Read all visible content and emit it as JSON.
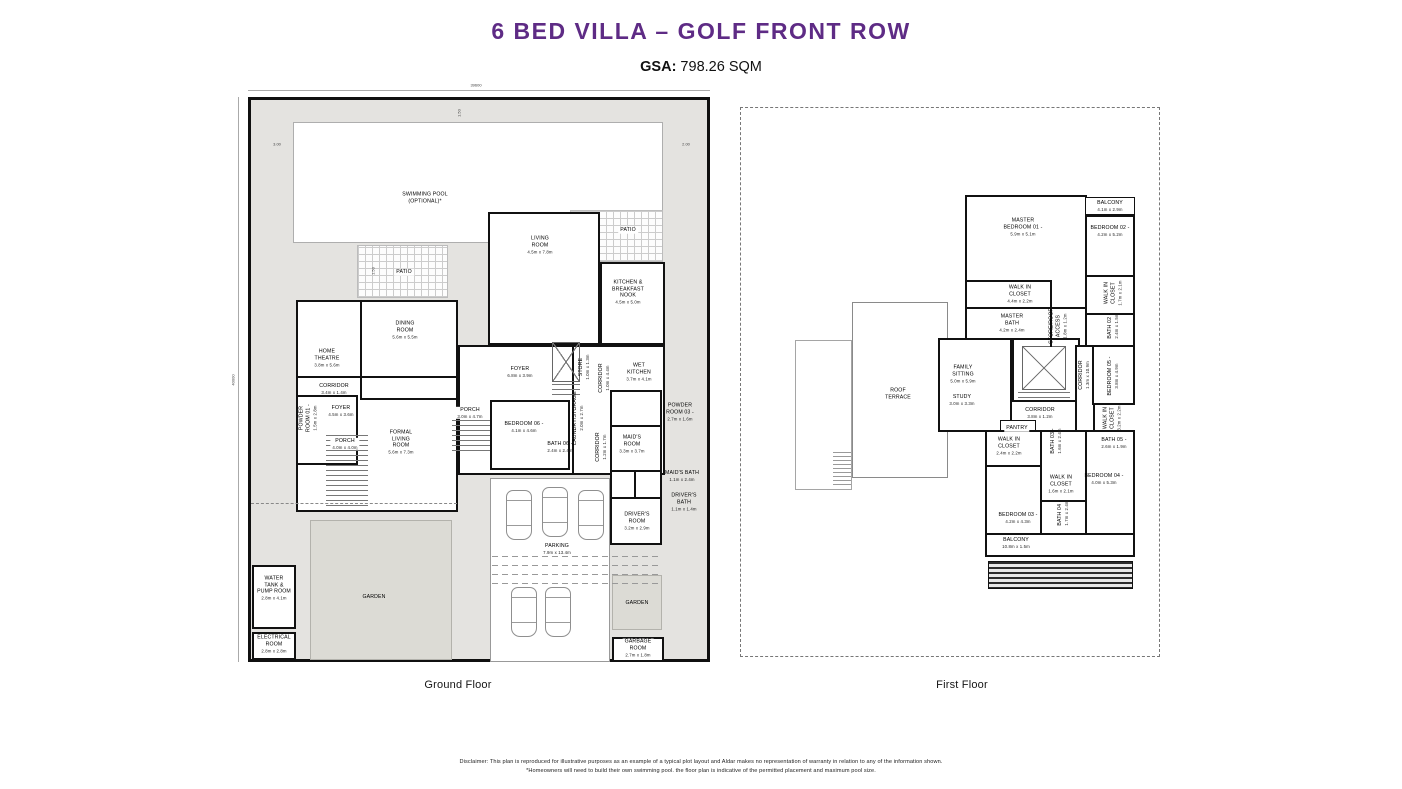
{
  "header": {
    "title_main": "6 BED VILLA",
    "title_sep": " – ",
    "title_sub": "GOLF FRONT ROW",
    "gsa_label": "GSA:",
    "gsa_value": " 798.26 SQM",
    "title_color": "#5E2B85"
  },
  "colors": {
    "accent_purple": "#5E2B85",
    "plot_fill": "#E4E3E0",
    "garden_fill": "#DCDBD5",
    "wall": "#101010"
  },
  "ground": {
    "caption": "Ground Floor",
    "dim_labels": [
      {
        "t": "39600",
        "x": 476,
        "y": 85,
        "r": 0
      },
      {
        "t": "40000",
        "x": 233,
        "y": 380,
        "r": 1
      },
      {
        "t": "3.00",
        "x": 277,
        "y": 144,
        "r": 0
      },
      {
        "t": "2.00",
        "x": 686,
        "y": 144,
        "r": 0
      },
      {
        "t": "1.50",
        "x": 459,
        "y": 113,
        "r": 1
      },
      {
        "t": "1.50",
        "x": 373,
        "y": 271,
        "r": 1
      }
    ],
    "labels": [
      {
        "n": "SWIMMING POOL\n(OPTIONAL)*",
        "d": "",
        "x": 425,
        "y": 198,
        "r": 0
      },
      {
        "n": "PATIO",
        "d": "",
        "x": 404,
        "y": 272,
        "r": 0,
        "w": 1
      },
      {
        "n": "PATIO",
        "d": "",
        "x": 628,
        "y": 230,
        "r": 0,
        "w": 1
      },
      {
        "n": "LIVING\nROOM",
        "d": "4.5m x 7.8m",
        "x": 540,
        "y": 245,
        "r": 0
      },
      {
        "n": "KITCHEN &\nBREAKFAST\nNOOK",
        "d": "4.5m x 5.0m",
        "x": 628,
        "y": 292,
        "r": 0
      },
      {
        "n": "DINING\nROOM",
        "d": "5.6m x 5.5m",
        "x": 405,
        "y": 330,
        "r": 0
      },
      {
        "n": "HOME\nTHEATRE",
        "d": "3.8m x 5.6m",
        "x": 327,
        "y": 358,
        "r": 0
      },
      {
        "n": "CORRIDOR",
        "d": "3.4m x 1.4m",
        "x": 334,
        "y": 389,
        "r": 0
      },
      {
        "n": "FOYER",
        "d": "6.8m x 3.9m",
        "x": 520,
        "y": 372,
        "r": 0
      },
      {
        "n": "STORE",
        "d": "1.0m x 1.3m",
        "x": 584,
        "y": 367,
        "r": 1
      },
      {
        "n": "CORRIDOR",
        "d": "1.0m x 4.4m",
        "x": 604,
        "y": 378,
        "r": 1
      },
      {
        "n": "WET\nKITCHEN",
        "d": "3.7m x 4.1m",
        "x": 639,
        "y": 372,
        "r": 0
      },
      {
        "n": "POWDER\nROOM 01 -",
        "d": "1.5m x 2.8m",
        "x": 308,
        "y": 418,
        "r": 1
      },
      {
        "n": "FOYER",
        "d": "4.5m x 3.6m",
        "x": 341,
        "y": 411,
        "r": 0
      },
      {
        "n": "PORCH",
        "d": "4.0m x 4.0m",
        "x": 345,
        "y": 444,
        "r": 0,
        "w": 1
      },
      {
        "n": "FORMAL\nLIVING\nROOM",
        "d": "5.6m x 7.3m",
        "x": 401,
        "y": 442,
        "r": 0
      },
      {
        "n": "PORCH",
        "d": "3.0m x 4.7m",
        "x": 470,
        "y": 413,
        "r": 0,
        "w": 1
      },
      {
        "n": "BEDROOM 06 -",
        "d": "4.1m x 4.6m",
        "x": 524,
        "y": 427,
        "r": 0
      },
      {
        "n": "BATH 06 -",
        "d": "2.4m x 2.4m",
        "x": 560,
        "y": 447,
        "r": 0
      },
      {
        "n": "LAUNDRY/STORAGE",
        "d": "2.0m x 2.7m",
        "x": 578,
        "y": 418,
        "r": 1
      },
      {
        "n": "CORRIDOR",
        "d": "1.2m x 1.7m",
        "x": 601,
        "y": 447,
        "r": 1
      },
      {
        "n": "MAID'S\nROOM",
        "d": "3.3m x 3.7m",
        "x": 632,
        "y": 444,
        "r": 0
      },
      {
        "n": "POWDER\nROOM 03 -",
        "d": "2.7m x 1.6m",
        "x": 680,
        "y": 412,
        "r": 0
      },
      {
        "n": "MAID'S BATH",
        "d": "1.1m x 2.4m",
        "x": 682,
        "y": 476,
        "r": 0
      },
      {
        "n": "DRIVER'S\nBATH",
        "d": "1.1m x 1.4m",
        "x": 684,
        "y": 502,
        "r": 0
      },
      {
        "n": "DRIVER'S\nROOM",
        "d": "3.2m x 2.9m",
        "x": 637,
        "y": 521,
        "r": 0
      },
      {
        "n": "PARKING",
        "d": "7.9m x 13.4m",
        "x": 557,
        "y": 549,
        "r": 0,
        "w": 1
      },
      {
        "n": "GARDEN",
        "d": "",
        "x": 374,
        "y": 597,
        "r": 0
      },
      {
        "n": "GARDEN",
        "d": "",
        "x": 637,
        "y": 603,
        "r": 0
      },
      {
        "n": "GARBAGE\nROOM",
        "d": "2.7m x 1.8m",
        "x": 638,
        "y": 648,
        "r": 0,
        "w": 1
      },
      {
        "n": "WATER\nTANK &\nPUMP ROOM",
        "d": "2.8m x 4.1m",
        "x": 274,
        "y": 588,
        "r": 0
      },
      {
        "n": "ELECTRICAL\nROOM",
        "d": "2.8m x 2.8m",
        "x": 274,
        "y": 644,
        "r": 0
      }
    ]
  },
  "first": {
    "caption": "First Floor",
    "labels": [
      {
        "n": "MASTER\nBEDROOM 01 -",
        "d": "5.9m x 5.1m",
        "x": 1023,
        "y": 227,
        "r": 0
      },
      {
        "n": "BALCONY",
        "d": "4.1m x 2.9m",
        "x": 1110,
        "y": 206,
        "r": 0,
        "w": 1
      },
      {
        "n": "BEDROOM 02 -",
        "d": "4.2m x 5.2m",
        "x": 1110,
        "y": 231,
        "r": 0
      },
      {
        "n": "WALK IN\nCLOSET",
        "d": "4.4m x 2.2m",
        "x": 1020,
        "y": 294,
        "r": 0
      },
      {
        "n": "MASTER\nBATH",
        "d": "4.2m x 2.4m",
        "x": 1012,
        "y": 323,
        "r": 0
      },
      {
        "n": "STORE/ROOF\nACCESS",
        "d": "1.8m x 1.2m",
        "x": 1058,
        "y": 326,
        "r": 1
      },
      {
        "n": "WALK IN\nCLOSET",
        "d": "1.7m x 2.1m",
        "x": 1113,
        "y": 293,
        "r": 1
      },
      {
        "n": "BATH 02 -",
        "d": "2.4m x 1.5m",
        "x": 1113,
        "y": 326,
        "r": 1
      },
      {
        "n": "FAMILY\nSITTING",
        "d": "5.0m x 5.9m",
        "x": 963,
        "y": 374,
        "r": 0
      },
      {
        "n": "STUDY",
        "d": "3.0m x 3.3m",
        "x": 962,
        "y": 400,
        "r": 0
      },
      {
        "n": "CORRIDOR",
        "d": "1.3m x 10.9m",
        "x": 1084,
        "y": 375,
        "r": 1
      },
      {
        "n": "BEDROOM 05 -",
        "d": "3.8m x 4.9m",
        "x": 1113,
        "y": 376,
        "r": 1
      },
      {
        "n": "CORRIDOR",
        "d": "3.8m x 1.2m",
        "x": 1040,
        "y": 413,
        "r": 0
      },
      {
        "n": "PANTRY",
        "d": "",
        "x": 1017,
        "y": 428,
        "r": 0,
        "w": 1
      },
      {
        "n": "WALK IN\nCLOSET",
        "d": "3.2m x 2.2m",
        "x": 1112,
        "y": 418,
        "r": 1
      },
      {
        "n": "BATH 05 -",
        "d": "2.6m x 1.9m",
        "x": 1114,
        "y": 443,
        "r": 0
      },
      {
        "n": "WALK IN\nCLOSET",
        "d": "2.4m x 2.2m",
        "x": 1009,
        "y": 446,
        "r": 0
      },
      {
        "n": "BATH 03 -",
        "d": "1.6m x 2.4m",
        "x": 1056,
        "y": 441,
        "r": 1
      },
      {
        "n": "WALK IN\nCLOSET",
        "d": "1.6m x 2.1m",
        "x": 1061,
        "y": 484,
        "r": 0
      },
      {
        "n": "BATH 04 -",
        "d": "1.7m x 2.4m",
        "x": 1063,
        "y": 513,
        "r": 1
      },
      {
        "n": "BEDROOM 04 -",
        "d": "4.0m x 5.3m",
        "x": 1104,
        "y": 479,
        "r": 0
      },
      {
        "n": "BEDROOM 03 -",
        "d": "4.2m x 4.3m",
        "x": 1018,
        "y": 518,
        "r": 0
      },
      {
        "n": "BALCONY",
        "d": "10.8m x 1.5m",
        "x": 1016,
        "y": 543,
        "r": 0
      },
      {
        "n": "ROOF\nTERRACE",
        "d": "",
        "x": 898,
        "y": 394,
        "r": 0
      }
    ]
  },
  "disclaimer": {
    "line1": "Disclaimer: This plan is reproduced for illustrative purposes as an example of a typical plot layout and Aldar makes no representation of warranty in relation to any of the information shown.",
    "line2": "*Homeowners will need to build their own swimming pool. the floor plan is indicative of the permitted placement and maximum pool size."
  }
}
